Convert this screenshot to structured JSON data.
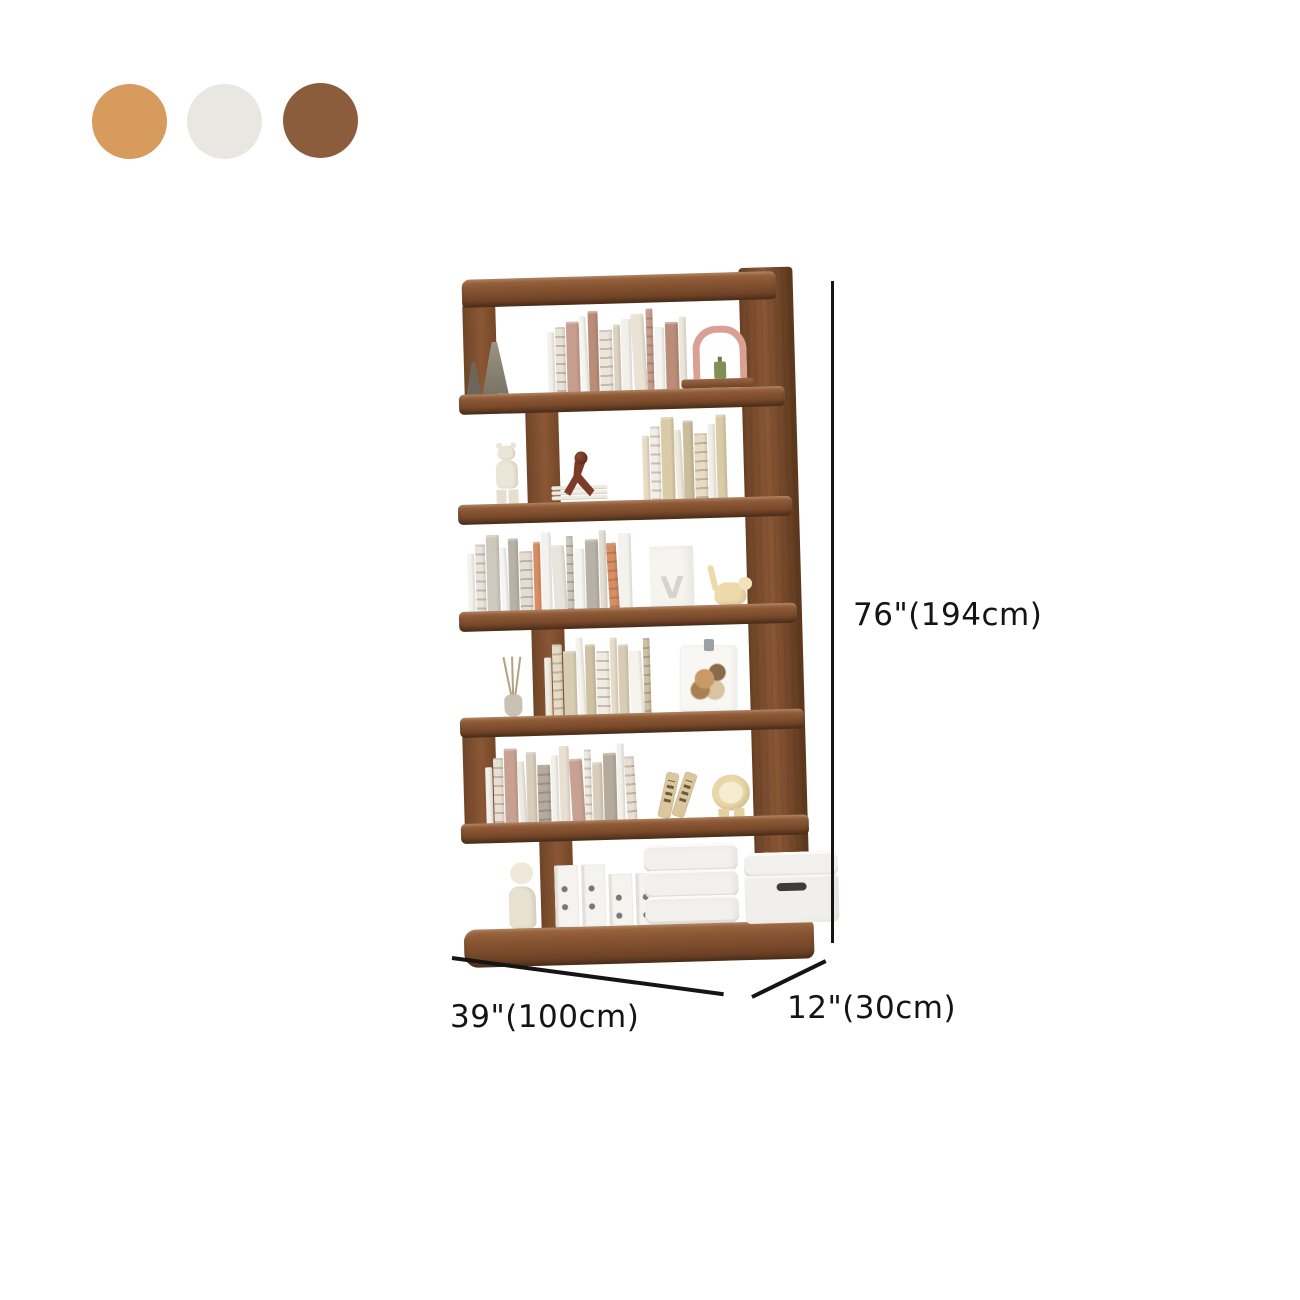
{
  "swatches": {
    "items": [
      {
        "name": "oak-tan",
        "color": "#D69B5D"
      },
      {
        "name": "off-white",
        "color": "#E9E7E2"
      },
      {
        "name": "walnut-brown",
        "color": "#8C5D3D"
      }
    ]
  },
  "dimensions": {
    "height": "76\"(194cm)",
    "width": "39\"(100cm)",
    "depth": "12\"(30cm)"
  },
  "product": {
    "type": "six-tier-staggered-bookshelf",
    "finish": "walnut",
    "bag_mark": "V",
    "colors": {
      "wood_front": "#8a5735",
      "wood_dark": "#5f3a20",
      "wood_light": "#a06a42",
      "dimension_line": "#151515"
    },
    "shelves": [
      {
        "tier": 1,
        "decor": [
          "ceramic-cone-vases",
          "arch-ornament-with-bottle"
        ],
        "books": {
          "count": 13,
          "hmin": 62,
          "hmax": 86,
          "palette": [
            "#f3f0ea",
            "#e9e2d5",
            "#c79d8e",
            "#f6f4ef",
            "#b98d77",
            "#ece5d9",
            "#ddd2c0"
          ]
        }
      },
      {
        "tier": 2,
        "decor": [
          "bearbrick-figure",
          "red-figurine",
          "magazine-stack"
        ],
        "books": {
          "count": 8,
          "hmin": 66,
          "hmax": 88,
          "palette": [
            "#e7dcc4",
            "#f2eee6",
            "#d9cba6",
            "#efe9dd",
            "#cbbd9a"
          ]
        }
      },
      {
        "tier": 3,
        "decor": [
          "white-gift-bag",
          "wooden-cat-figurine"
        ],
        "books": {
          "count": 15,
          "hmin": 60,
          "hmax": 82,
          "palette": [
            "#f4f2ed",
            "#e8e4db",
            "#cfc9bd",
            "#f7f5f1",
            "#b8b2a6",
            "#e3ddd2",
            "#d98e62"
          ]
        }
      },
      {
        "tier": 4,
        "decor": [
          "reed-diffuser-vase",
          "floral-flip-calendar"
        ],
        "books": {
          "count": 10,
          "hmin": 60,
          "hmax": 80,
          "palette": [
            "#f1ece1",
            "#e6dcc6",
            "#d8cdb4",
            "#f6f3ec",
            "#cfc2a4"
          ]
        }
      },
      {
        "tier": 5,
        "decor": [
          "comb-bookends",
          "lion-figurine"
        ],
        "books": {
          "count": 14,
          "hmin": 58,
          "hmax": 80,
          "palette": [
            "#f3f0ea",
            "#e9e0d2",
            "#c9a193",
            "#efeadf",
            "#d8cdbb",
            "#b5ab9c"
          ]
        }
      },
      {
        "tier": 6,
        "decor": [
          "squirrel-figurine",
          "file-binders",
          "stacked-storage-trays",
          "storage-bin-with-handle"
        ],
        "books": null
      }
    ]
  }
}
